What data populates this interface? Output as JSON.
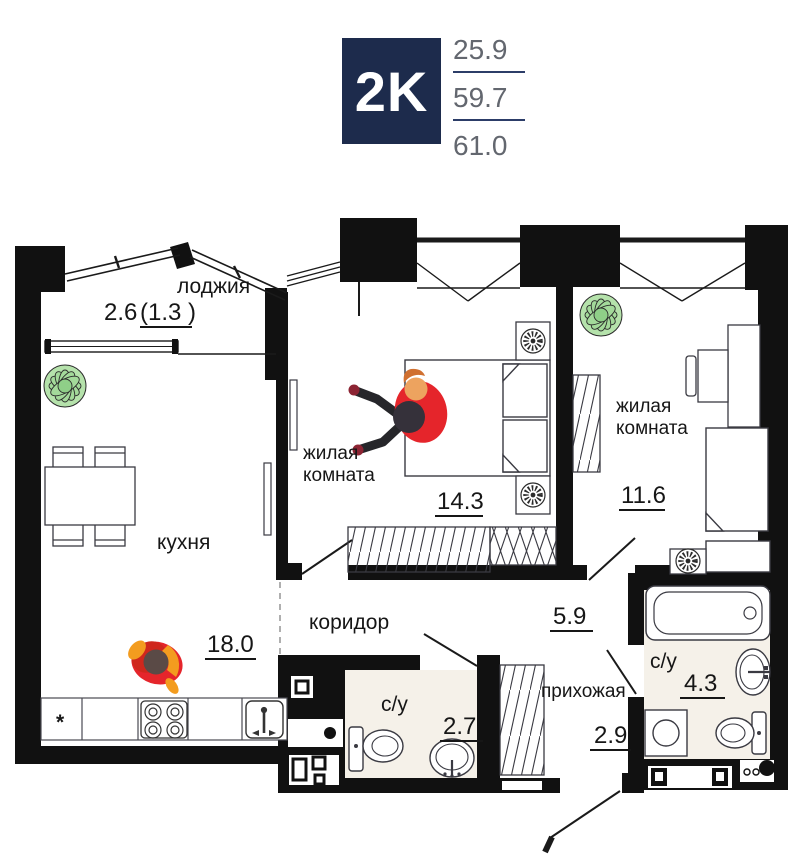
{
  "header": {
    "type_badge": "2K",
    "living_area": "25.9",
    "apartment_area": "59.7",
    "total_area": "61.0"
  },
  "rooms": {
    "loggia": {
      "name": "лоджия",
      "area": "2.6",
      "area_coef": "(1.3 )"
    },
    "kitchen": {
      "name": "кухня",
      "area": "18.0",
      "fridge_mark": "*"
    },
    "bedroom1": {
      "name_line1": "жилая",
      "name_line2": "комната",
      "area": "14.3"
    },
    "bedroom2": {
      "name_line1": "жилая",
      "name_line2": "комната",
      "area": "11.6"
    },
    "corridor": {
      "name": "коридор",
      "area": "5.9"
    },
    "hallway": {
      "name": "прихожая",
      "area": "2.9"
    },
    "bathroom": {
      "name": "с/у",
      "area": "4.3"
    },
    "toilet": {
      "name": "с/у",
      "area": "2.7"
    }
  },
  "colors": {
    "badge_bg": "#1d2b4c",
    "underline_accent": "#2c3d68",
    "badge_numbers": "#63676f",
    "wall": "#111111",
    "bath_floor": "#f5f1e9",
    "plant_green": "#a3d99a",
    "figure_red": "#e5252b",
    "figure_orange": "#f39c1f"
  }
}
